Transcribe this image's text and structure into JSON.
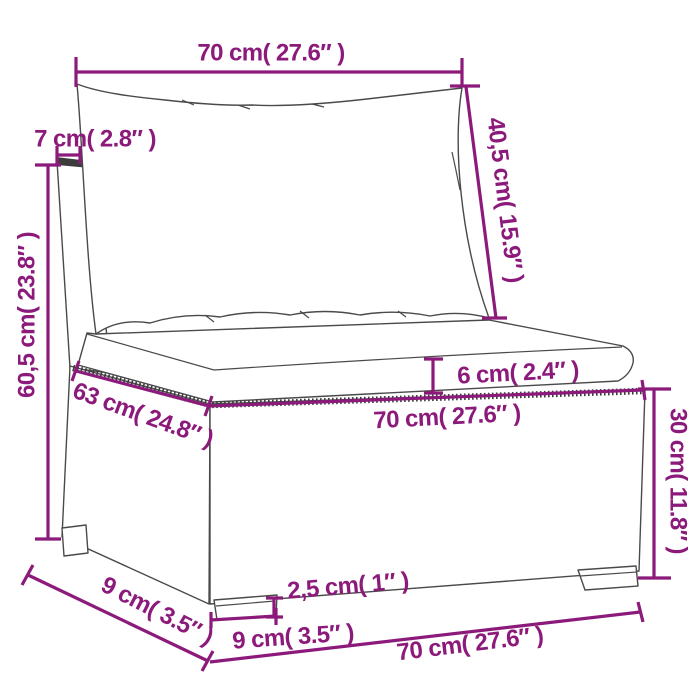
{
  "product": "poly-rattan-sofa-middle-section-dimension-diagram",
  "colors": {
    "dimension_accent": "#8C1A7B",
    "line_art": "#4a4a4a"
  },
  "labels": {
    "top_width": "70 cm( 27.6″ )",
    "back_thickness": "7 cm( 2.8″ )",
    "total_height": "60,5 cm( 23.8″ )",
    "back_height": "40,5 cm( 15.9″ )",
    "cushion_thickness": "6 cm( 2.4″ )",
    "seat_depth": "63 cm( 24.8″ )",
    "seat_width": "70 cm( 27.6″ )",
    "base_height": "30 cm( 11.8″ )",
    "foot_height": "2,5 cm( 1″ )",
    "foot_width": "9 cm( 3.5″ )",
    "side_depth": "9 cm( 3.5″ )",
    "bottom_width": "70 cm( 27.6″ )"
  }
}
